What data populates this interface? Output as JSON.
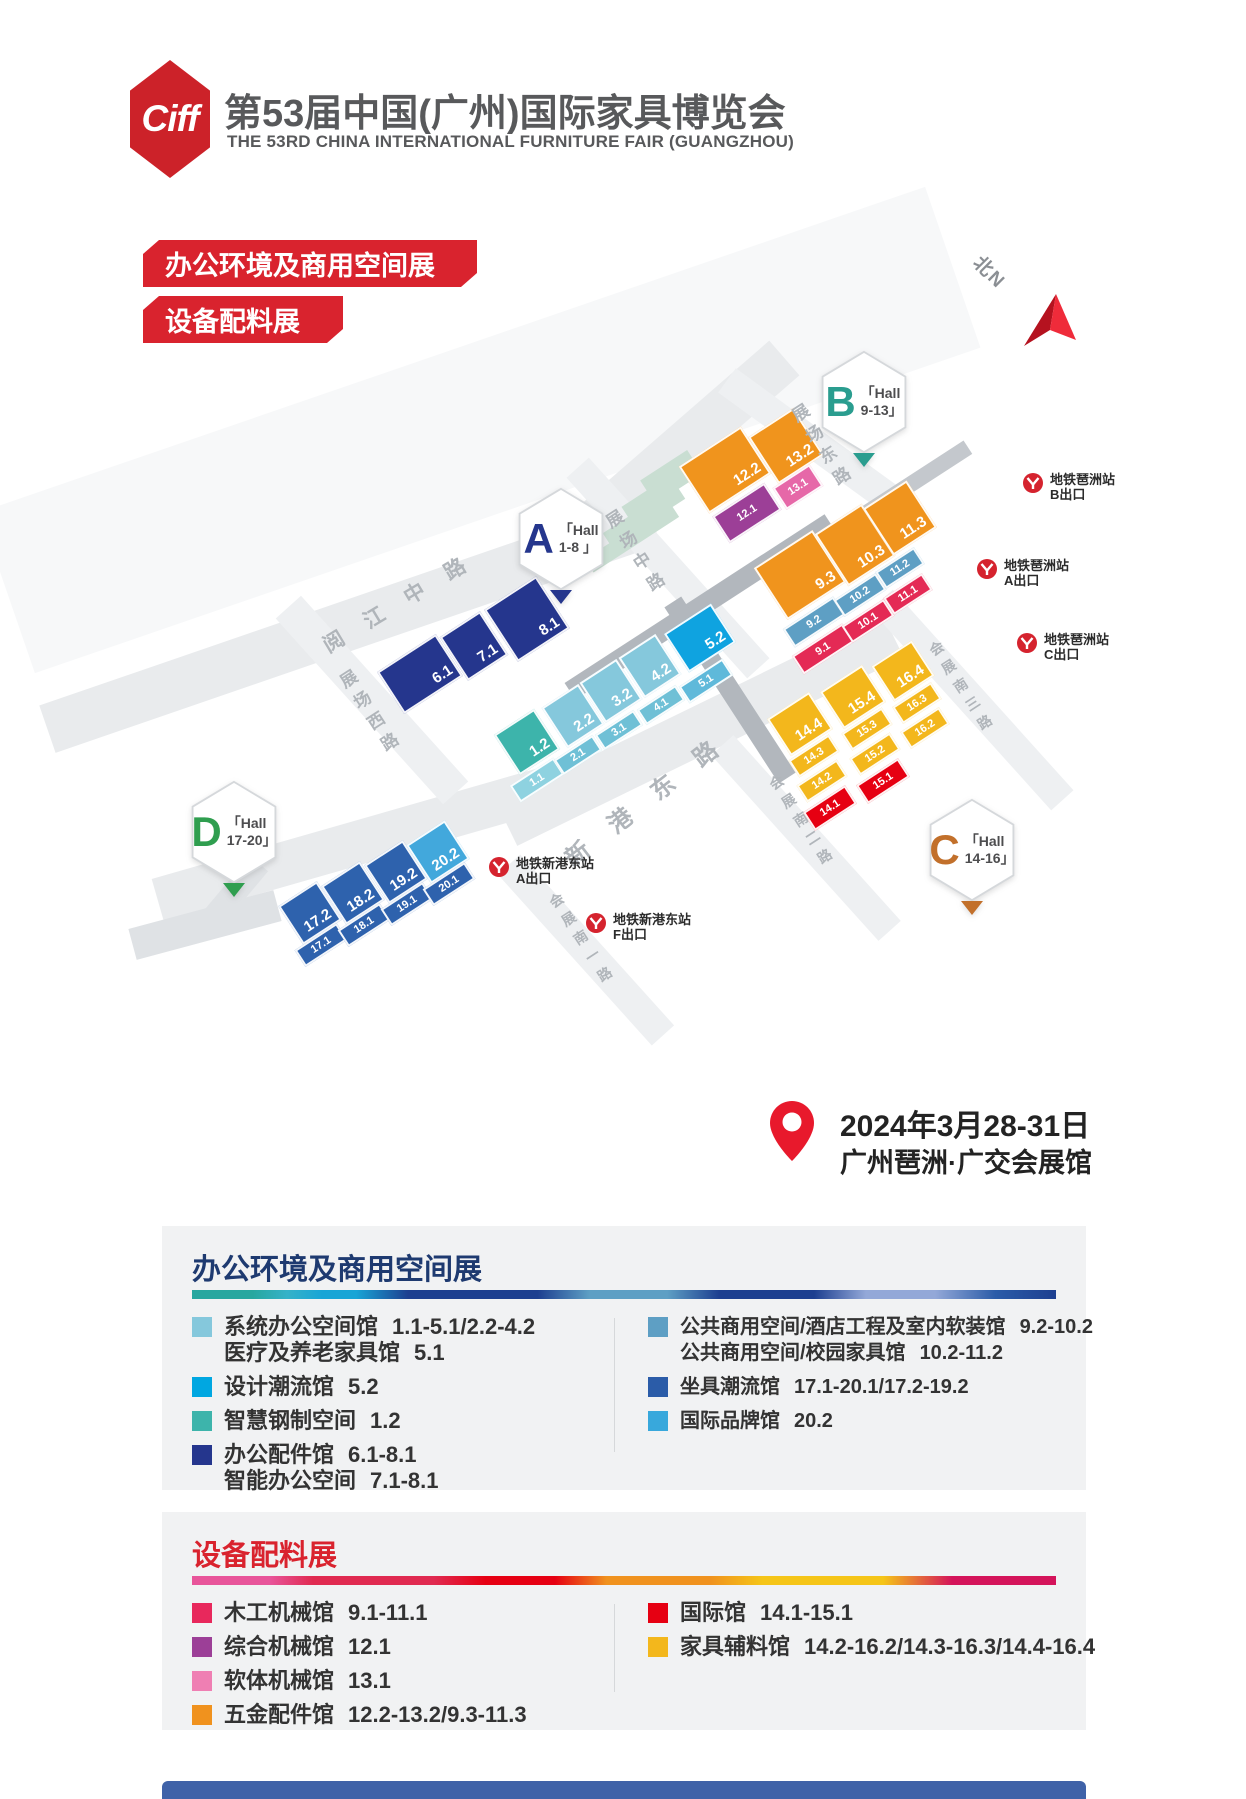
{
  "header": {
    "logo_text": "Ciff",
    "title_cn": "第53届中国(广州)国际家具博览会",
    "title_en": "THE 53RD CHINA INTERNATIONAL FURNITURE FAIR (GUANGZHOU)"
  },
  "banners": [
    {
      "label": "办公环境及商用空间展"
    },
    {
      "label": "设备配料展"
    }
  ],
  "event": {
    "date": "2024年3月28-31日",
    "venue": "广州琶洲·广交会展馆"
  },
  "map": {
    "north_label": "北N",
    "halls": [
      {
        "letter": "A",
        "line1": "「Hall",
        "line2": "1-8 」",
        "color": "#25368d",
        "x": 515,
        "y": 487
      },
      {
        "letter": "B",
        "line1": "「Hall",
        "line2": "9-13」",
        "color": "#2a9d8f",
        "x": 818,
        "y": 350
      },
      {
        "letter": "C",
        "line1": "「Hall",
        "line2": "14-16」",
        "color": "#c2702b",
        "x": 926,
        "y": 798
      },
      {
        "letter": "D",
        "line1": "「Hall",
        "line2": "17-20」",
        "color": "#2f9e4f",
        "x": 188,
        "y": 780
      }
    ],
    "roads": [
      {
        "cx": 480,
        "cy": 430,
        "w": 1000,
        "h": 170,
        "rot": -19,
        "c": "#f7f8f9"
      },
      {
        "cx": 350,
        "cy": 625,
        "w": 640,
        "h": 50,
        "rot": -19,
        "c": "#e9ebed"
      },
      {
        "cx": 690,
        "cy": 440,
        "w": 250,
        "h": 46,
        "rot": -41,
        "c": "#e9ebed"
      },
      {
        "cx": 350,
        "cy": 845,
        "w": 400,
        "h": 44,
        "rot": -16,
        "c": "#e9ebed"
      },
      {
        "cx": 700,
        "cy": 730,
        "w": 430,
        "h": 48,
        "rot": -26,
        "c": "#e9ebed"
      },
      {
        "cx": 668,
        "cy": 568,
        "w": 270,
        "h": 30,
        "rot": 48,
        "c": "#eef0f2"
      },
      {
        "cx": 820,
        "cy": 448,
        "w": 230,
        "h": 30,
        "rot": 36,
        "c": "#eef0f2"
      },
      {
        "cx": 372,
        "cy": 700,
        "w": 250,
        "h": 34,
        "rot": 48,
        "c": "#eef0f2"
      },
      {
        "cx": 972,
        "cy": 700,
        "w": 270,
        "h": 30,
        "rot": 48,
        "c": "#eef0f2"
      },
      {
        "cx": 806,
        "cy": 838,
        "w": 250,
        "h": 30,
        "rot": 48,
        "c": "#eef0f2"
      },
      {
        "cx": 586,
        "cy": 950,
        "w": 230,
        "h": 30,
        "rot": 48,
        "c": "#eef0f2"
      },
      {
        "cx": 205,
        "cy": 925,
        "w": 150,
        "h": 32,
        "rot": -15,
        "c": "#dfe2e5"
      },
      {
        "cx": 230,
        "cy": 898,
        "w": 24,
        "h": 90,
        "rot": 40,
        "c": "#dfe2e5"
      },
      {
        "cx": 700,
        "cy": 607,
        "w": 310,
        "h": 20,
        "rot": -33,
        "c": "#b2b7bd"
      },
      {
        "cx": 730,
        "cy": 690,
        "w": 20,
        "h": 210,
        "rot": -33,
        "c": "#b2b7bd"
      },
      {
        "cx": 905,
        "cy": 488,
        "w": 150,
        "h": 16,
        "rot": -33,
        "c": "#c4c8cd"
      }
    ],
    "road_labels_h": [
      {
        "t": "阅江中路",
        "x": 405,
        "y": 598,
        "rot": -31,
        "ls": 26,
        "fs": 21
      },
      {
        "t": "新港东路",
        "x": 652,
        "y": 793,
        "rot": -38,
        "ls": 30,
        "fs": 24
      }
    ],
    "road_labels_v": [
      {
        "t": "展场中路",
        "x": 636,
        "y": 556,
        "fs": 17
      },
      {
        "t": "展场东路",
        "x": 822,
        "y": 450,
        "fs": 17
      },
      {
        "t": "展场西路",
        "x": 370,
        "y": 716,
        "fs": 17
      },
      {
        "t": "会展南三路",
        "x": 966,
        "y": 690,
        "fs": 14
      },
      {
        "t": "会展南二路",
        "x": 806,
        "y": 824,
        "fs": 14
      },
      {
        "t": "会展南一路",
        "x": 586,
        "y": 942,
        "fs": 14
      }
    ],
    "deco": [
      {
        "cx": 668,
        "cy": 472,
        "w": 56,
        "h": 16
      },
      {
        "cx": 656,
        "cy": 494,
        "w": 72,
        "h": 16
      },
      {
        "cx": 644,
        "cy": 516,
        "w": 88,
        "h": 16
      },
      {
        "cx": 632,
        "cy": 538,
        "w": 102,
        "h": 16
      }
    ],
    "blocks": [
      {
        "l": "6.1",
        "x": 420,
        "y": 674,
        "w": 70,
        "h": 50,
        "c": "#25368d",
        "big": 1
      },
      {
        "l": "7.1",
        "x": 474,
        "y": 646,
        "w": 48,
        "h": 52,
        "c": "#25368d",
        "big": 1
      },
      {
        "l": "8.1",
        "x": 527,
        "y": 619,
        "w": 62,
        "h": 62,
        "c": "#25368d",
        "big": 1
      },
      {
        "l": "1.2",
        "x": 527,
        "y": 742,
        "w": 48,
        "h": 48,
        "c": "#3db4ab",
        "big": 1
      },
      {
        "l": "2.2",
        "x": 573,
        "y": 716,
        "w": 44,
        "h": 48,
        "c": "#85c8dc",
        "big": 1
      },
      {
        "l": "3.2",
        "x": 611,
        "y": 691,
        "w": 44,
        "h": 48,
        "c": "#85c8dc",
        "big": 1
      },
      {
        "l": "4.2",
        "x": 650,
        "y": 666,
        "w": 44,
        "h": 48,
        "c": "#85c8dc",
        "big": 1
      },
      {
        "l": "5.2",
        "x": 700,
        "y": 638,
        "w": 56,
        "h": 46,
        "c": "#0fa3e0",
        "big": 1
      },
      {
        "l": "1.1",
        "x": 537,
        "y": 780,
        "w": 52,
        "h": 20,
        "c": "#8ed2e0"
      },
      {
        "l": "2.1",
        "x": 578,
        "y": 755,
        "w": 46,
        "h": 18,
        "c": "#6fc0d6"
      },
      {
        "l": "3.1",
        "x": 619,
        "y": 730,
        "w": 46,
        "h": 18,
        "c": "#6fc0d6"
      },
      {
        "l": "4.1",
        "x": 661,
        "y": 705,
        "w": 46,
        "h": 18,
        "c": "#6fc0d6"
      },
      {
        "l": "5.1",
        "x": 706,
        "y": 681,
        "w": 52,
        "h": 20,
        "c": "#5fb9da"
      },
      {
        "l": "12.2",
        "x": 725,
        "y": 470,
        "w": 74,
        "h": 56,
        "c": "#f0941d",
        "big": 1
      },
      {
        "l": "13.2",
        "x": 786,
        "y": 446,
        "w": 54,
        "h": 56,
        "c": "#f0941d",
        "big": 1
      },
      {
        "l": "12.1",
        "x": 747,
        "y": 513,
        "w": 62,
        "h": 32,
        "c": "#9c3f97"
      },
      {
        "l": "13.1",
        "x": 798,
        "y": 487,
        "w": 44,
        "h": 26,
        "c": "#e668a8"
      },
      {
        "l": "9.3",
        "x": 800,
        "y": 575,
        "w": 70,
        "h": 62,
        "c": "#f0941d",
        "big": 1
      },
      {
        "l": "10.3",
        "x": 855,
        "y": 545,
        "w": 56,
        "h": 62,
        "c": "#f0941d",
        "big": 1
      },
      {
        "l": "11.3",
        "x": 900,
        "y": 518,
        "w": 52,
        "h": 56,
        "c": "#f0941d",
        "big": 1
      },
      {
        "l": "9.2",
        "x": 814,
        "y": 622,
        "w": 60,
        "h": 22,
        "c": "#5e9fc4"
      },
      {
        "l": "10.2",
        "x": 860,
        "y": 595,
        "w": 50,
        "h": 20,
        "c": "#5e9fc4"
      },
      {
        "l": "11.2",
        "x": 900,
        "y": 568,
        "w": 46,
        "h": 20,
        "c": "#5e9fc4"
      },
      {
        "l": "9.1",
        "x": 823,
        "y": 649,
        "w": 60,
        "h": 22,
        "c": "#e42a55"
      },
      {
        "l": "10.1",
        "x": 868,
        "y": 621,
        "w": 50,
        "h": 20,
        "c": "#e42a55"
      },
      {
        "l": "11.1",
        "x": 908,
        "y": 594,
        "w": 46,
        "h": 20,
        "c": "#e42a55"
      },
      {
        "l": "14.4",
        "x": 800,
        "y": 724,
        "w": 50,
        "h": 44,
        "c": "#f3b71c",
        "big": 1
      },
      {
        "l": "15.4",
        "x": 853,
        "y": 697,
        "w": 50,
        "h": 44,
        "c": "#f3b71c",
        "big": 1
      },
      {
        "l": "16.4",
        "x": 903,
        "y": 671,
        "w": 48,
        "h": 42,
        "c": "#f3b71c",
        "big": 1
      },
      {
        "l": "14.3",
        "x": 814,
        "y": 756,
        "w": 48,
        "h": 20,
        "c": "#f3b71c"
      },
      {
        "l": "15.3",
        "x": 867,
        "y": 729,
        "w": 48,
        "h": 20,
        "c": "#f3b71c"
      },
      {
        "l": "16.3",
        "x": 917,
        "y": 703,
        "w": 46,
        "h": 20,
        "c": "#f3b71c"
      },
      {
        "l": "14.2",
        "x": 822,
        "y": 781,
        "w": 48,
        "h": 20,
        "c": "#f3b71c"
      },
      {
        "l": "15.2",
        "x": 875,
        "y": 754,
        "w": 48,
        "h": 20,
        "c": "#f3b71c"
      },
      {
        "l": "16.2",
        "x": 925,
        "y": 728,
        "w": 46,
        "h": 20,
        "c": "#f3b71c"
      },
      {
        "l": "14.1",
        "x": 830,
        "y": 808,
        "w": 50,
        "h": 22,
        "c": "#e60012"
      },
      {
        "l": "15.1",
        "x": 883,
        "y": 781,
        "w": 50,
        "h": 22,
        "c": "#e60012"
      },
      {
        "l": "17.2",
        "x": 310,
        "y": 913,
        "w": 46,
        "h": 46,
        "c": "#2e62ad",
        "big": 1
      },
      {
        "l": "18.2",
        "x": 353,
        "y": 893,
        "w": 46,
        "h": 46,
        "c": "#2e62ad",
        "big": 1
      },
      {
        "l": "19.2",
        "x": 396,
        "y": 872,
        "w": 46,
        "h": 46,
        "c": "#2e62ad",
        "big": 1
      },
      {
        "l": "20.2",
        "x": 438,
        "y": 852,
        "w": 46,
        "h": 46,
        "c": "#42a8dc",
        "big": 1
      },
      {
        "l": "17.1",
        "x": 321,
        "y": 945,
        "w": 50,
        "h": 20,
        "c": "#2e62ad"
      },
      {
        "l": "18.1",
        "x": 364,
        "y": 925,
        "w": 50,
        "h": 20,
        "c": "#2e62ad"
      },
      {
        "l": "19.1",
        "x": 407,
        "y": 904,
        "w": 50,
        "h": 20,
        "c": "#2e62ad"
      },
      {
        "l": "20.1",
        "x": 449,
        "y": 884,
        "w": 50,
        "h": 20,
        "c": "#2e62ad"
      }
    ],
    "metro": [
      {
        "station": "地铁琶洲站",
        "exit": "B出口",
        "x": 1022,
        "y": 472
      },
      {
        "station": "地铁琶洲站",
        "exit": "A出口",
        "x": 976,
        "y": 558
      },
      {
        "station": "地铁琶洲站",
        "exit": "C出口",
        "x": 1016,
        "y": 632
      },
      {
        "station": "地铁新港东站",
        "exit": "A出口",
        "x": 488,
        "y": 856
      },
      {
        "station": "地铁新港东站",
        "exit": "F出口",
        "x": 585,
        "y": 912
      }
    ]
  },
  "legends": [
    {
      "title": "办公环境及商用空间展",
      "title_color": "#1e3a70",
      "bar": "linear-gradient(90deg,#27a79f 0%,#27a79f 7%,#35b2c8 11%,#18a5d6 15%,#18a5d6 19%,#1d3f90 25%,#1d3f90 40%,#5e9fc4 46%,#5e9fc4 55%,#1d3f90 61%,#1d3f90 72%,#93a8d8 78%,#93a8d8 86%,#2b5ca8 93%,#1d3f90 100%)",
      "x": 162,
      "y": 1226,
      "w": 924,
      "h": 264,
      "columns": [
        [
          {
            "swatch": "#85c8dc",
            "lines": [
              {
                "name": "系统办公空间馆",
                "range": "1.1-5.1/2.2-4.2"
              },
              {
                "name": "医疗及养老家具馆",
                "range": "5.1"
              }
            ]
          },
          {
            "swatch": "#00a7e1",
            "lines": [
              {
                "name": "设计潮流馆",
                "range": "5.2"
              }
            ]
          },
          {
            "swatch": "#3db4ab",
            "lines": [
              {
                "name": "智慧钢制空间",
                "range": "1.2"
              }
            ]
          },
          {
            "swatch": "#25368d",
            "lines": [
              {
                "name": "办公配件馆",
                "range": "6.1-8.1"
              },
              {
                "name": "智能办公空间",
                "range": "7.1-8.1"
              }
            ]
          }
        ],
        [
          {
            "swatch": "#5e9fc4",
            "lines": [
              {
                "name": "公共商用空间/酒店工程及室内软装馆",
                "range": "9.2-10.2"
              },
              {
                "name": "公共商用空间/校园家具馆",
                "range": "10.2-11.2"
              }
            ]
          },
          {
            "swatch": "#2b5ca8",
            "lines": [
              {
                "name": "坐具潮流馆",
                "range": "17.1-20.1/17.2-19.2"
              }
            ]
          },
          {
            "swatch": "#38a8dc",
            "lines": [
              {
                "name": "国际品牌馆",
                "range": "20.2"
              }
            ]
          }
        ]
      ]
    },
    {
      "title": "设备配料展",
      "title_color": "#d9232e",
      "bar": "linear-gradient(90deg,#e8559a 0%,#e8559a 9%,#e02a50 14%,#e02a50 28%,#e60012 34%,#e60012 42%,#f0921e 48%,#f0921e 60%,#f5c518 66%,#f5c518 80%,#d4145a 88%,#d4145a 100%)",
      "x": 162,
      "y": 1512,
      "w": 924,
      "h": 218,
      "columns": [
        [
          {
            "swatch": "#e8285c",
            "lines": [
              {
                "name": "木工机械馆",
                "range": "9.1-11.1"
              }
            ]
          },
          {
            "swatch": "#9c3f97",
            "lines": [
              {
                "name": "综合机械馆",
                "range": "12.1"
              }
            ]
          },
          {
            "swatch": "#ef7fb3",
            "lines": [
              {
                "name": "软体机械馆",
                "range": "13.1"
              }
            ]
          },
          {
            "swatch": "#f0921e",
            "lines": [
              {
                "name": "五金配件馆",
                "range": "12.2-13.2/9.3-11.3"
              }
            ]
          }
        ],
        [
          {
            "swatch": "#e60012",
            "lines": [
              {
                "name": "国际馆",
                "range": "14.1-15.1"
              }
            ]
          },
          {
            "swatch": "#f3b71c",
            "lines": [
              {
                "name": "家具辅料馆",
                "range": "14.2-16.2/14.3-16.3/14.4-16.4"
              }
            ]
          }
        ]
      ]
    }
  ]
}
